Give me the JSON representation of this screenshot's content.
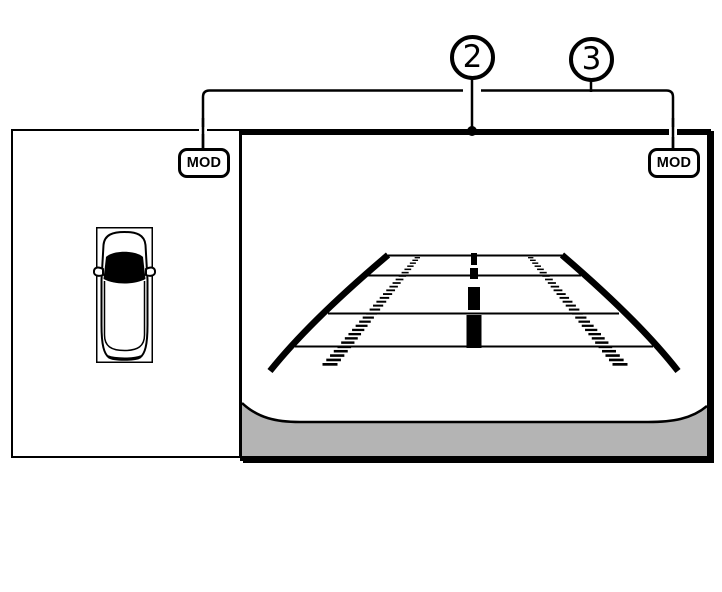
{
  "figure": {
    "description": "Rear view monitor diagram with moving object detection indicators",
    "callouts": [
      {
        "label": "2",
        "points_to": "top edge of rear camera view"
      },
      {
        "label": "3",
        "points_to": "MOD indicators on both screens"
      }
    ],
    "left_panel": {
      "view": "birds-eye vehicle top view",
      "badge_label": "MOD"
    },
    "right_panel": {
      "view": "rear camera view with guide lines",
      "badge_label": "MOD"
    },
    "colors": {
      "line": "#000000",
      "bumper_gray": "#b4b4b4",
      "background": "#ffffff"
    }
  }
}
